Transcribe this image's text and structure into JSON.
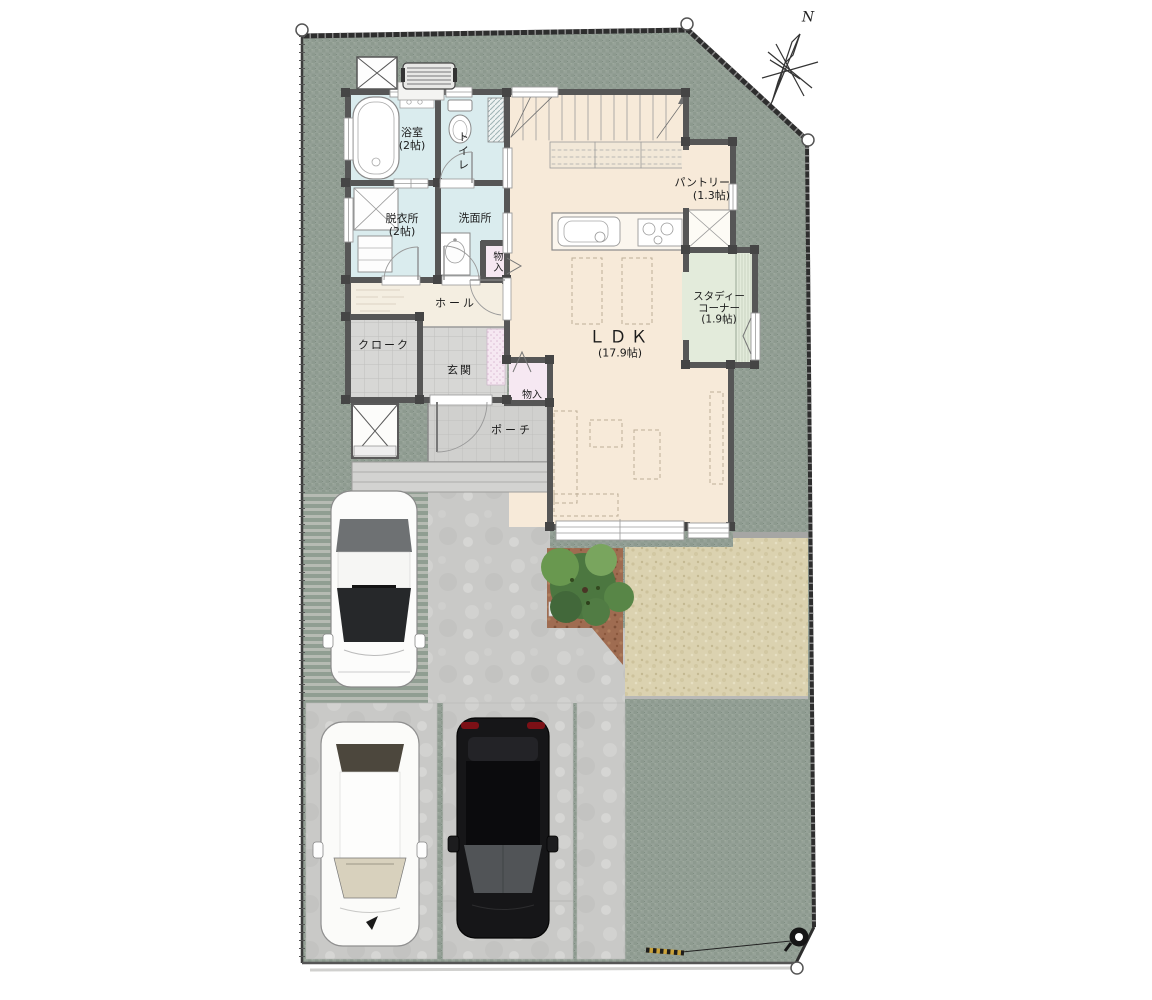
{
  "plan": {
    "compass": {
      "north": "N"
    },
    "rooms": {
      "bathroom": {
        "name": "浴室",
        "area": "(2帖)"
      },
      "toilet": {
        "name": "トイレ"
      },
      "dressing_room": {
        "name": "脱衣所",
        "area": "(2帖)"
      },
      "washroom": {
        "name": "洗面所"
      },
      "storage_washroom": {
        "name": "物入"
      },
      "hall": {
        "name": "ホール"
      },
      "cloak": {
        "name": "クローク"
      },
      "entrance": {
        "name": "玄関"
      },
      "storage_entrance": {
        "name": "物入"
      },
      "porch": {
        "name": "ポーチ"
      },
      "ldk": {
        "name": "ＬＤＫ",
        "area": "(17.9帖)"
      },
      "pantry": {
        "name": "パントリー",
        "area": "(1.3帖)"
      },
      "study_corner": {
        "name_line1": "スタディー",
        "name_line2": "コーナー",
        "area": "(1.9帖)"
      }
    },
    "colors": {
      "site_green": "#96a298",
      "floor": "#f7ead9",
      "wet_room": "#daecee",
      "study_green": "#e3ebdb",
      "storage_pink": "#f6e8f2",
      "tile_gray": "#d7d7d5",
      "terrace_beige": "#dbd2b0",
      "planting_brown": "#9f6c51",
      "concrete": "#c9c9c7",
      "wall": "#565656"
    },
    "objects": {
      "cars": [
        "white-car-upper",
        "white-car-lower",
        "black-suv"
      ],
      "tree": "garden-tree",
      "utility_pole": "utility-pole",
      "equipment": [
        "hot-water-unit",
        "equipment-pad",
        "outdoor-storage-box"
      ]
    }
  }
}
